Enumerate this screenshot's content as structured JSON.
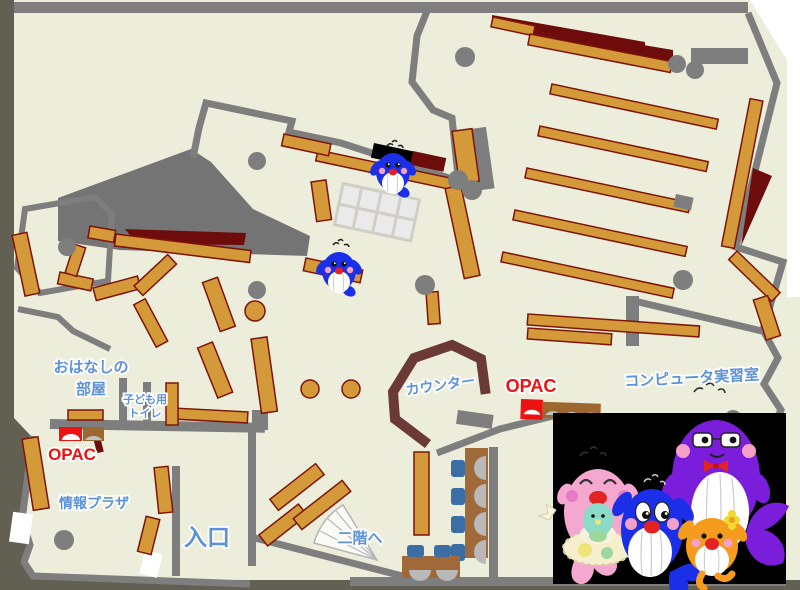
{
  "map_title": "library-floor-map",
  "labels": {
    "storytelling_l1": "おはなしの",
    "storytelling_l2": "部屋",
    "toilet_l1": "子ども用",
    "toilet_l2": "トイレ",
    "opac_left": "OPAC",
    "opac_right": "OPAC",
    "info_plaza": "情報プラザ",
    "entrance": "入口",
    "to_2f": "二階へ",
    "counter": "カウンター",
    "computer_room": "コンピュータ実習室"
  },
  "colors": {
    "floor": "#ECEDDB",
    "wall": "#7E7E7E",
    "outside": "#616052",
    "inner_zone_gray": "#747474",
    "shelf": "#D49A3A",
    "shelf_border": "#7E1408",
    "dark_red": "#6E0B0B",
    "counter": "#6B3A36",
    "label_blue": "#5D92D8",
    "label_red": "#EE1111",
    "chair_blue": "#3A6EA5",
    "desk_brown": "#A0693A",
    "photo_background": "#000000",
    "mascot_blue": "#1C2FE8",
    "mascot_pink": "#F5A8CF",
    "mascot_purple": "#7A1EDB",
    "mascot_orange": "#F59B1E"
  },
  "icons": [
    {
      "name": "blue-whale-mascot-top"
    },
    {
      "name": "blue-whale-mascot-left"
    },
    {
      "name": "pink-whale-mascot"
    },
    {
      "name": "blue-whale-mascot-photo"
    },
    {
      "name": "purple-whale-mascot"
    },
    {
      "name": "orange-whale-mascot"
    },
    {
      "name": "stairs-fan"
    },
    {
      "name": "opac-terminal-left"
    },
    {
      "name": "opac-terminal-right"
    },
    {
      "name": "study-carrel-desks"
    },
    {
      "name": "reading-table-grid"
    }
  ]
}
